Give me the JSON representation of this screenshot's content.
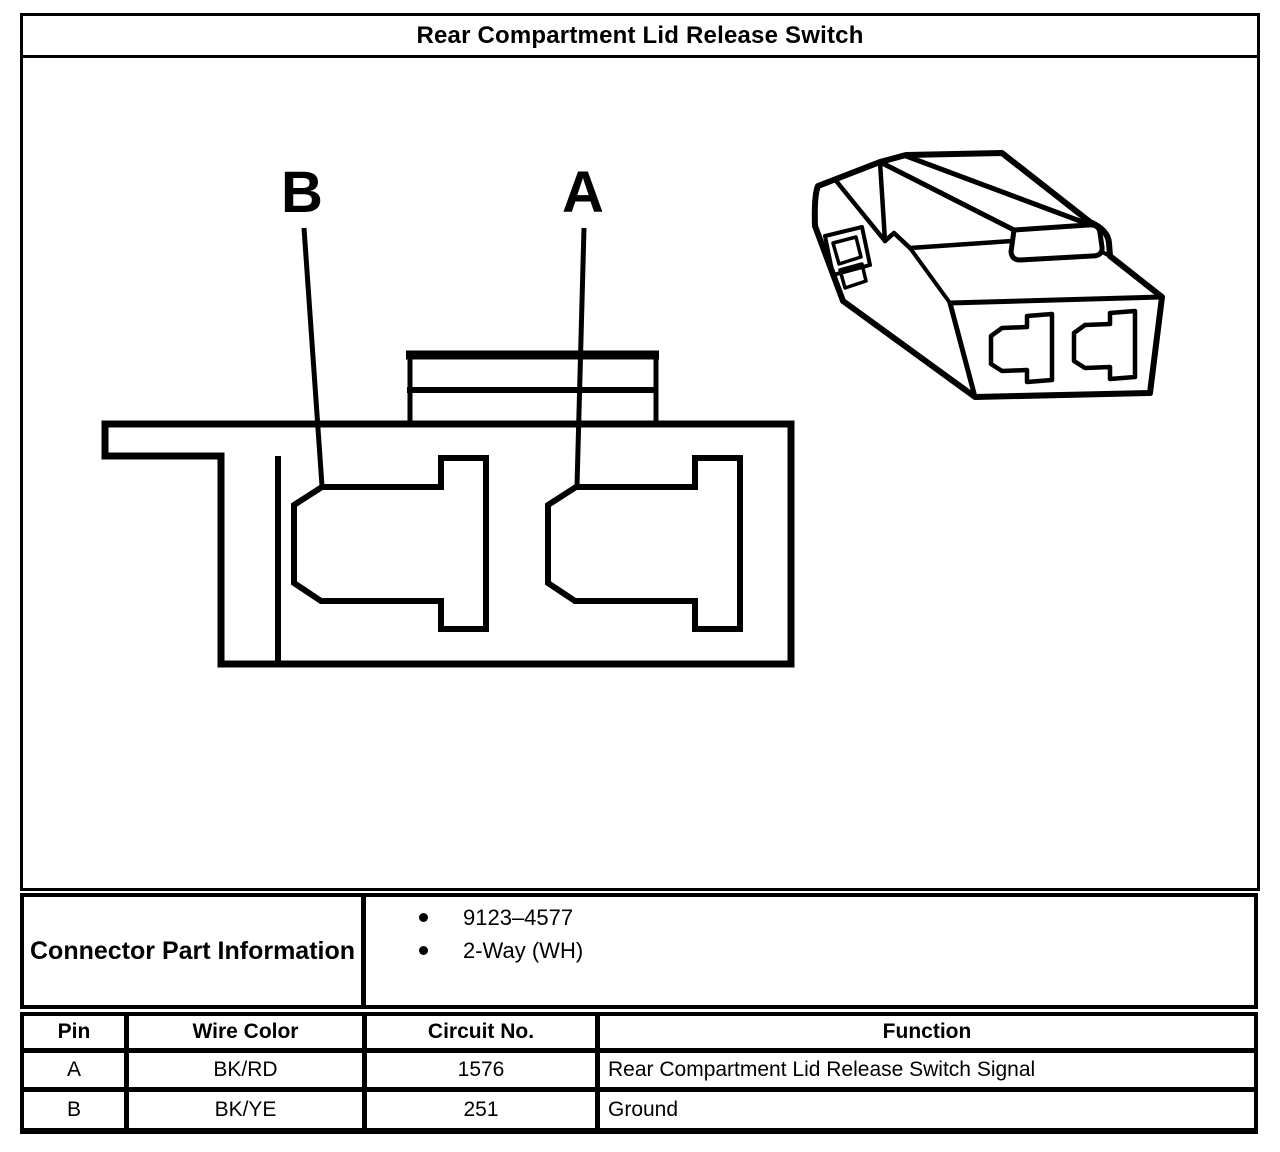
{
  "title": "Rear Compartment Lid Release Switch",
  "diagram": {
    "pin_labels": {
      "a": "A",
      "b": "B"
    }
  },
  "part_info": {
    "label": "Connector Part Information",
    "bullets": [
      "9123–4577",
      "2-Way (WH)"
    ]
  },
  "pin_table": {
    "headers": [
      "Pin",
      "Wire Color",
      "Circuit No.",
      "Function"
    ],
    "rows": [
      {
        "pin": "A",
        "wire_color": "BK/RD",
        "circuit_no": "1576",
        "function": "Rear Compartment Lid Release Switch Signal"
      },
      {
        "pin": "B",
        "wire_color": "BK/YE",
        "circuit_no": "251",
        "function": "Ground"
      }
    ]
  },
  "colors": {
    "line": "#000000",
    "background": "#ffffff"
  }
}
